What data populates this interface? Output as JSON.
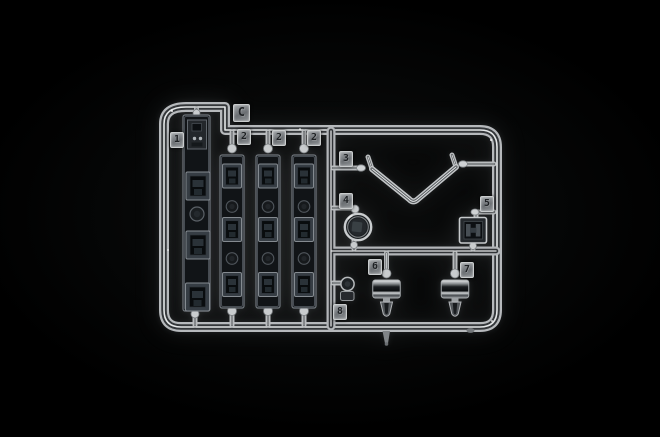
{
  "scene": {
    "description": "Macro photograph of a clear-plastic model kit sprue (transparent parts tree C) on a black studio background",
    "background_color": "#000000",
    "plastic_highlight": "#eef0f1",
    "plastic_midtone": "#a7abae",
    "plastic_shadow": "#2c2f32",
    "smoked_part_color": "#101316"
  },
  "sprue": {
    "letter_label": "C",
    "part_labels": {
      "p1": "1",
      "p2a": "2",
      "p2b": "2",
      "p2c": "2",
      "p3": "3",
      "p4": "4",
      "p5": "5",
      "p6": "6",
      "p7": "7",
      "p8": "8"
    }
  }
}
